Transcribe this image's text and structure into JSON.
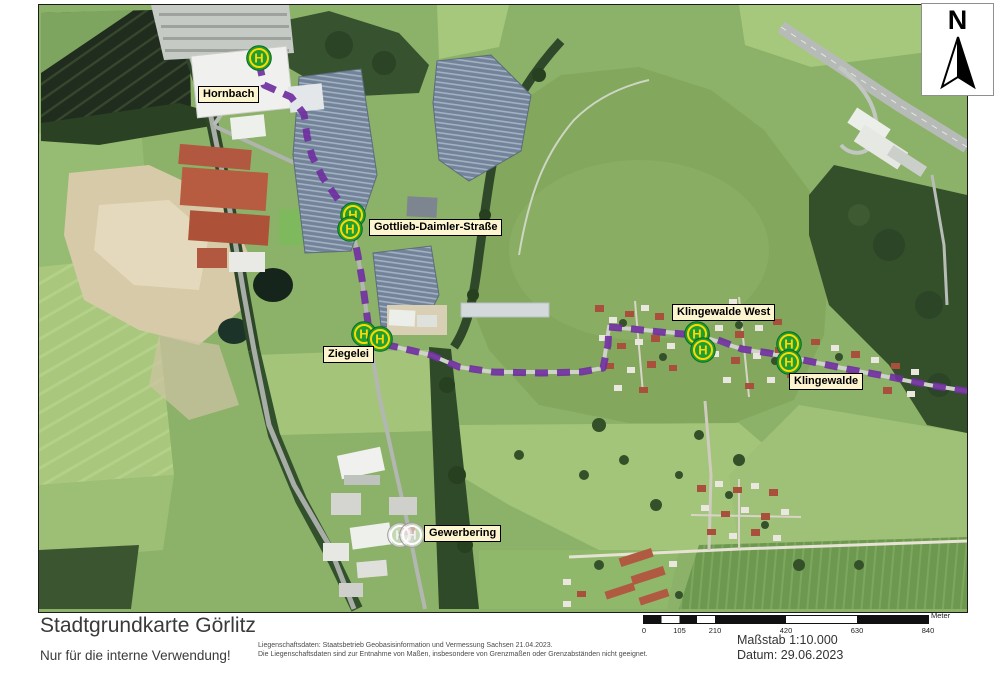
{
  "map": {
    "stops": [
      {
        "name": "Hornbach",
        "state": "active",
        "label": {
          "x": 159,
          "y": 81
        },
        "markers": [
          {
            "x": 220,
            "y": 53
          }
        ]
      },
      {
        "name": "Gottlieb-Daimler-Straße",
        "state": "active",
        "label": {
          "x": 330,
          "y": 214
        },
        "markers": [
          {
            "x": 314,
            "y": 210
          },
          {
            "x": 311,
            "y": 224
          }
        ]
      },
      {
        "name": "Ziegelei",
        "state": "active",
        "label": {
          "x": 284,
          "y": 341
        },
        "markers": [
          {
            "x": 325,
            "y": 329
          },
          {
            "x": 341,
            "y": 334
          }
        ]
      },
      {
        "name": "Klingewalde West",
        "state": "active",
        "label": {
          "x": 633,
          "y": 299
        },
        "markers": [
          {
            "x": 658,
            "y": 329
          },
          {
            "x": 664,
            "y": 345
          }
        ]
      },
      {
        "name": "Klingewalde",
        "state": "active",
        "label": {
          "x": 750,
          "y": 368
        },
        "markers": [
          {
            "x": 750,
            "y": 339
          },
          {
            "x": 750,
            "y": 357
          }
        ]
      },
      {
        "name": "Gewerbering",
        "state": "inactive",
        "label": {
          "x": 385,
          "y": 520
        },
        "markers": [
          {
            "x": 361,
            "y": 530
          },
          {
            "x": 373,
            "y": 530
          }
        ]
      }
    ],
    "route": {
      "color": "#7030a0",
      "points": "220,58 225,80 252,92 265,109 268,131 273,151 284,173 298,193 311,209 314,226 319,251 323,274 326,296 329,318 331,336 362,343 392,350 420,362 454,367 502,368 542,367 564,363 569,340 570,322 594,324 630,328 658,330 679,335 703,344 730,348 750,352 774,357 808,364 852,372 890,380 928,386"
    },
    "marker_colors": {
      "circle": "#1f9e34",
      "circle_edge": "#0c6b1e",
      "ring": "#ffd800",
      "letter": "H",
      "inactive_circle": "rgba(245,245,245,0.55)",
      "inactive_edge": "#9a9a9a",
      "inactive_ring": "#ffffff"
    },
    "north_arrow_label": "N"
  },
  "scale_bar": {
    "unit_label": "Meter",
    "ticks": [
      {
        "label": "0",
        "frac": 0
      },
      {
        "label": "105",
        "frac": 0.125
      },
      {
        "label": "210",
        "frac": 0.25
      },
      {
        "label": "420",
        "frac": 0.5
      },
      {
        "label": "630",
        "frac": 0.75
      },
      {
        "label": "840",
        "frac": 1
      }
    ]
  },
  "footer": {
    "title": "Stadtgrundkarte Görlitz",
    "usage_note": "Nur für die interne Verwendung!",
    "disclaimer_line1": "Liegenschaftsdaten: Staatsbetrieb Geobasisinformation und Vermessung Sachsen 21.04.2023.",
    "disclaimer_line2": "Die Liegenschaftsdaten sind zur Entnahme von Maßen, insbesondere von Grenzmaßen oder Grenzabständen nicht geeignet.",
    "scale_text": "Maßstab 1:10.000",
    "date_text": "Datum: 29.06.2023"
  }
}
